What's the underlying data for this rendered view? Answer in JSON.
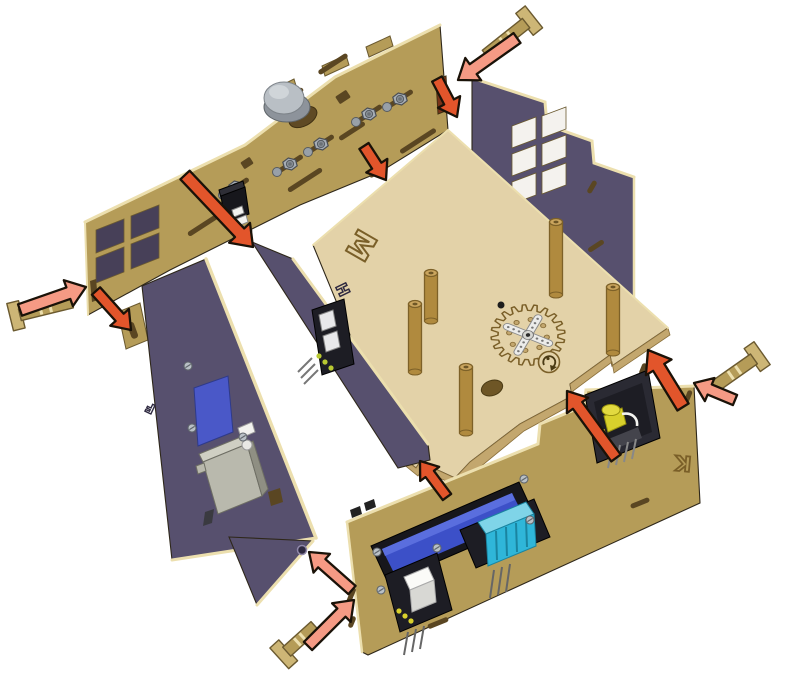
{
  "diagram": {
    "background": "#ffffff",
    "labels": {
      "base": "M",
      "left_panel": "F",
      "divider_panel": "H",
      "front_panel": "K"
    },
    "palette": {
      "bg": "#ffffff",
      "tan": "#b59c58",
      "tanLight": "#cdb676",
      "tanDark": "#7c6736",
      "cream": "#ecdfae",
      "plywood": "#e3d2a8",
      "plywoodLight": "#eee0bc",
      "plywoodEdge": "#c3a76e",
      "plywoodDark": "#8a6f3a",
      "purple": "#57506e",
      "purpleDark": "#433d55",
      "purpleLight": "#6a6282",
      "engrave": "#7a5f28",
      "engravePurple": "#2e2940",
      "arrowPink": "#f59a84",
      "arrowRed": "#e2552b",
      "outline": "#1a1208",
      "lcdFrame": "#17171c",
      "lcdBlue": "#3c50c8",
      "lcdBlueLight": "#5d71e0",
      "cyan": "#2fb6d9",
      "cyanDark": "#1a84a0",
      "pcb": "#1d1d24",
      "metal": "#a7aeb6",
      "metalDark": "#565b61",
      "whitePart": "#f2f2ef",
      "yellow": "#d8d02c",
      "dowel": "#b08a3e",
      "dowelDark": "#7d6128",
      "dowelTop": "#caa55e",
      "servo": "#b9b9ad",
      "servoDark": "#8f8f83",
      "slotDark": "#5a4622",
      "holeDark": "#2e2517"
    },
    "parts": [
      "potentiometer-knob",
      "pin-header-connector",
      "hex-nut",
      "locking-pin",
      "servo-motor",
      "sensor-module",
      "gear-with-servo-horn",
      "wood-dowel-peg",
      "lcd-display",
      "humidity-sensor-module",
      "button-module",
      "led-module"
    ],
    "arrows": [
      {
        "x1": 517,
        "y1": 38,
        "x2": 458,
        "y2": 80,
        "color": "pink",
        "scale": 1.1
      },
      {
        "x1": 437,
        "y1": 79,
        "x2": 457,
        "y2": 117,
        "color": "red",
        "scale": 1.0
      },
      {
        "x1": 185,
        "y1": 175,
        "x2": 253,
        "y2": 247,
        "color": "red",
        "scale": 1.15
      },
      {
        "x1": 364,
        "y1": 146,
        "x2": 386,
        "y2": 180,
        "color": "red",
        "scale": 1.0
      },
      {
        "x1": 20,
        "y1": 310,
        "x2": 86,
        "y2": 287,
        "color": "pink",
        "scale": 1.1
      },
      {
        "x1": 96,
        "y1": 291,
        "x2": 131,
        "y2": 330,
        "color": "red",
        "scale": 1.0
      },
      {
        "x1": 447,
        "y1": 497,
        "x2": 420,
        "y2": 461,
        "color": "red",
        "scale": 0.95
      },
      {
        "x1": 683,
        "y1": 407,
        "x2": 648,
        "y2": 350,
        "color": "red",
        "scale": 1.2
      },
      {
        "x1": 616,
        "y1": 458,
        "x2": 567,
        "y2": 391,
        "color": "red",
        "scale": 1.05
      },
      {
        "x1": 735,
        "y1": 400,
        "x2": 694,
        "y2": 383,
        "color": "pink",
        "scale": 1.0
      },
      {
        "x1": 352,
        "y1": 590,
        "x2": 309,
        "y2": 552,
        "color": "pink",
        "scale": 1.0
      },
      {
        "x1": 308,
        "y1": 646,
        "x2": 354,
        "y2": 600,
        "color": "pink",
        "scale": 1.05
      }
    ],
    "pins": [
      {
        "hx": 530,
        "hy": 20,
        "tx": 486,
        "ty": 55
      },
      {
        "hx": 15,
        "hy": 316,
        "tx": 72,
        "ty": 302
      },
      {
        "hx": 283,
        "hy": 655,
        "tx": 315,
        "ty": 626
      },
      {
        "hx": 758,
        "hy": 356,
        "tx": 714,
        "ty": 387
      }
    ],
    "dowels": [
      {
        "x": 431,
        "y": 270,
        "h": 48
      },
      {
        "x": 415,
        "y": 301,
        "h": 68
      },
      {
        "x": 466,
        "y": 364,
        "h": 66
      },
      {
        "x": 556,
        "y": 219,
        "h": 73
      },
      {
        "x": 613,
        "y": 284,
        "h": 66
      }
    ],
    "nuts": [
      [
        400,
        99
      ],
      [
        369,
        114
      ],
      [
        321,
        144
      ],
      [
        290,
        164
      ],
      [
        236,
        187
      ]
    ],
    "screws": [
      [
        188,
        366
      ],
      [
        192,
        428
      ],
      [
        243,
        437
      ],
      [
        377,
        552
      ],
      [
        381,
        590
      ],
      [
        524,
        479
      ],
      [
        530,
        520
      ],
      [
        437,
        548
      ]
    ],
    "gear": {
      "cx": 528,
      "cy": 335,
      "teeth": 20,
      "outerR": 37,
      "innerR": 30,
      "holeRingR": 19,
      "holeCount": 8,
      "hornAngle": 38
    }
  }
}
